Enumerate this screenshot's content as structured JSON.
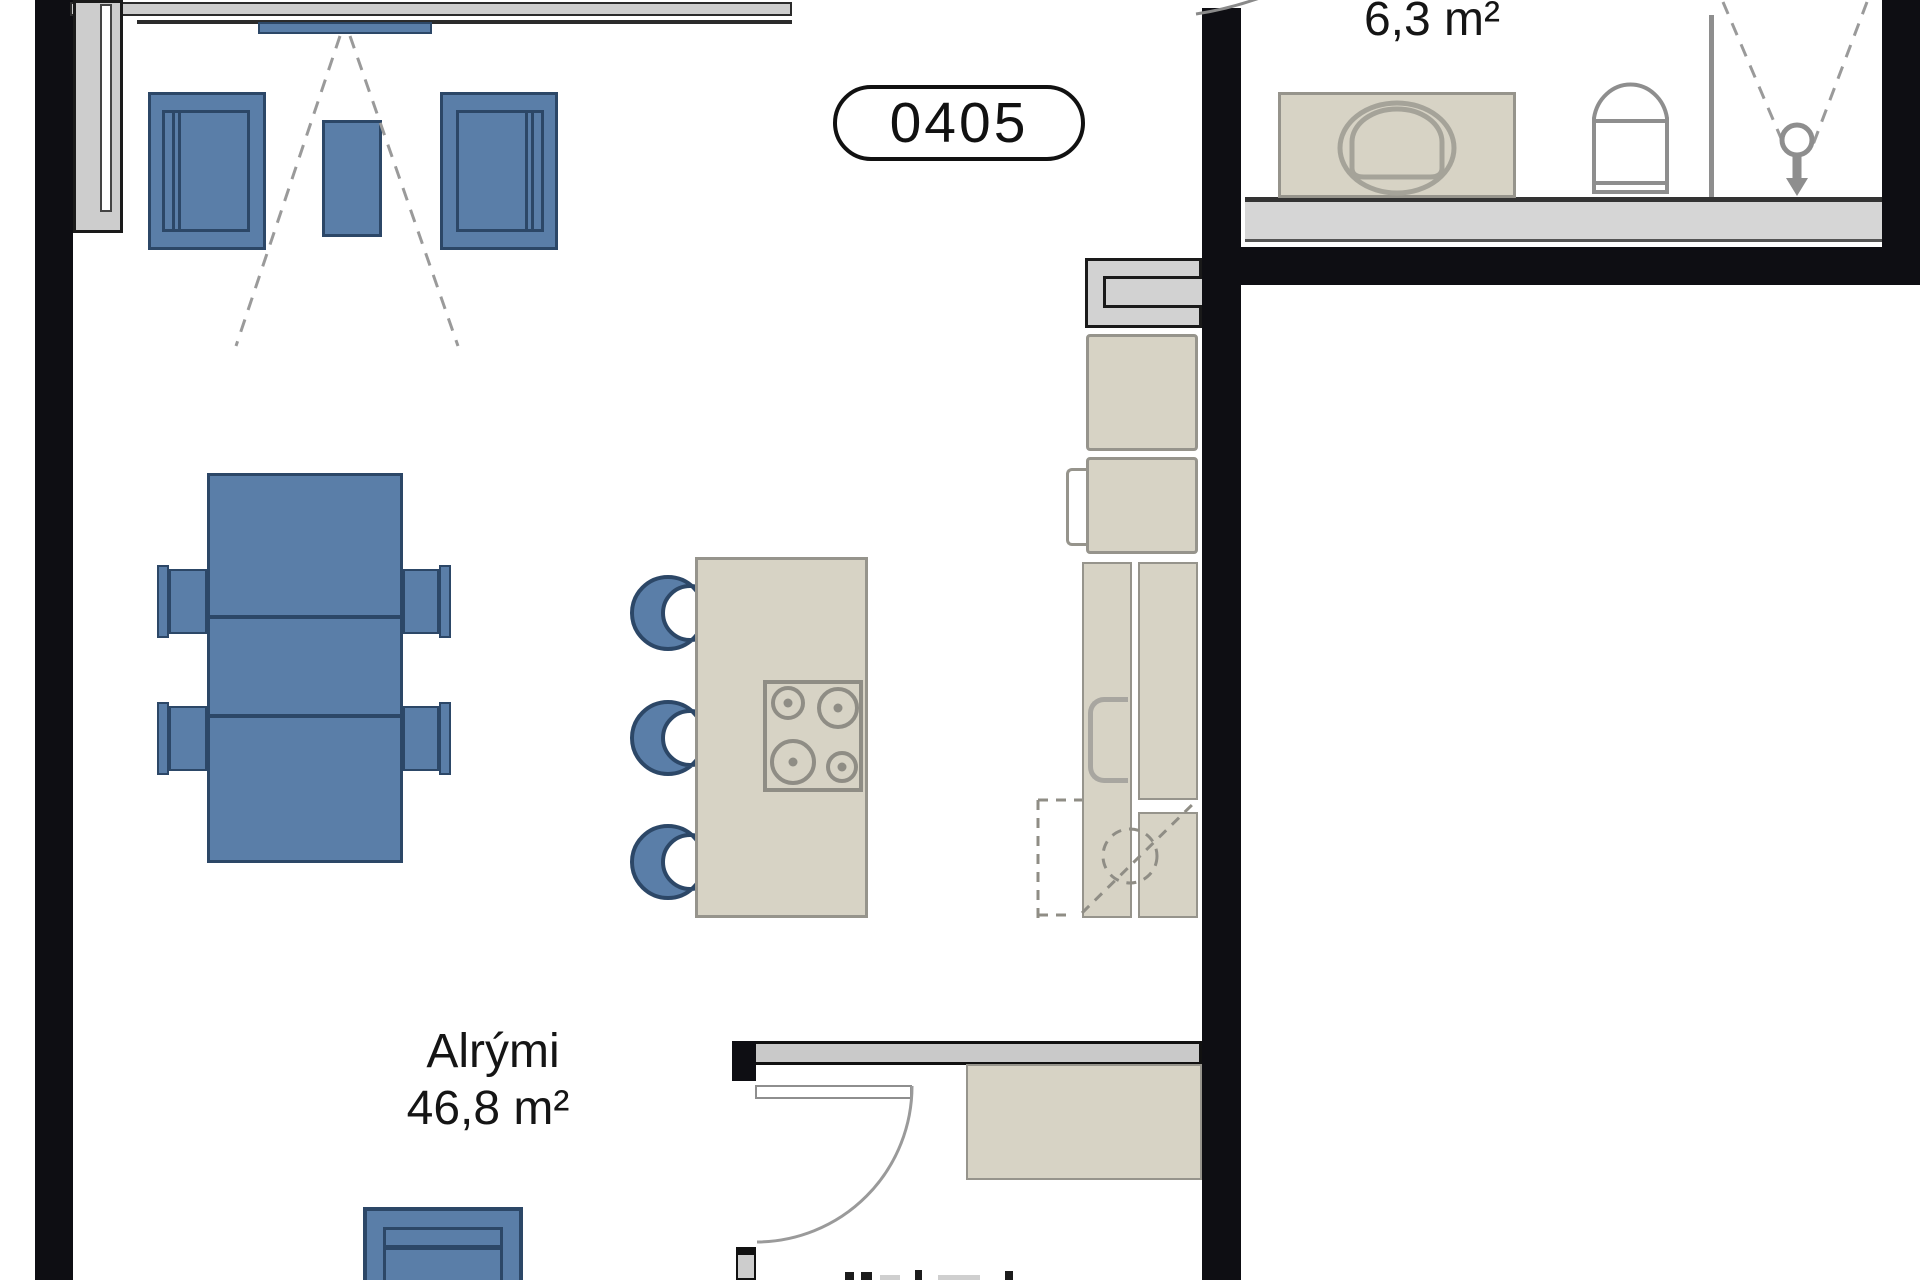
{
  "floorplan": {
    "unit_badge": "0405",
    "living_room": {
      "name": "Alrými",
      "area": "46,8 m²"
    },
    "bathroom": {
      "area": "6,3 m²"
    },
    "colors": {
      "furniture_blue": "#5a7ea8",
      "furniture_outline": "#2c4767",
      "cabinet_beige": "#d7d3c5",
      "cabinet_outline": "#96948c",
      "wall_black": "#0e0e13",
      "window_gray": "#cdcdcd",
      "fixture_gray": "#8e8e8e"
    }
  }
}
